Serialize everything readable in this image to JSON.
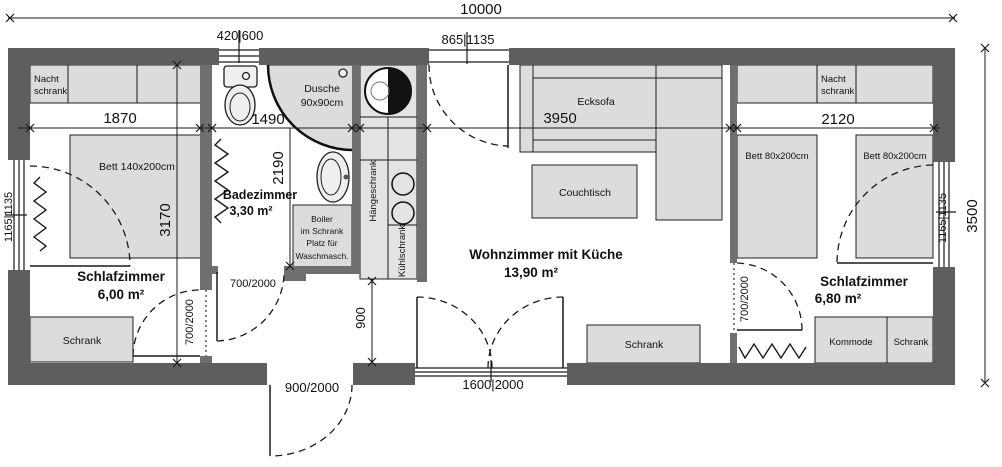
{
  "colors": {
    "wall_exterior": "#5e5e5e",
    "wall_interior": "#6f6f6f",
    "furniture_fill": "#dcdcdc",
    "line": "#1a1a1a",
    "background": "#ffffff"
  },
  "dimensions": {
    "overall_width": "10000",
    "overall_height": "3500",
    "bedroom_left_width": "1870",
    "bathroom_width": "1490",
    "living_width": "3950",
    "bedroom_right_width": "2120",
    "bedroom_left_depth": "3170",
    "bathroom_depth": "2190",
    "kitchen_passage": "900",
    "window_top": "420|600",
    "entry_door": "865|1135",
    "window_left": "1165|1135",
    "window_right": "1165|1135",
    "door_bottom": "900/2000",
    "window_bottom": "1600|2000",
    "door_bedroom_left": "700/2000",
    "door_bathroom": "700/2000",
    "door_bedroom_right": "700/2000"
  },
  "rooms": {
    "bedroom_left": {
      "name": "Schlafzimmer",
      "area": "6,00 m²"
    },
    "bathroom": {
      "name": "Badezimmer",
      "area": "3,30 m²"
    },
    "living": {
      "name": "Wohnzimmer mit Küche",
      "area": "13,90 m²"
    },
    "bedroom_right": {
      "name": "Schlafzimmer",
      "area": "6,80 m²"
    }
  },
  "furniture": {
    "nightstand_left_1": "Nacht",
    "nightstand_left_2": "schrank",
    "bed_left": "Bett 140x200cm",
    "wardrobe_left": "Schrank",
    "shower_1": "Dusche",
    "shower_2": "90x90cm",
    "boiler_1": "Boiler",
    "boiler_2": "im Schrank",
    "boiler_3": "Platz für",
    "boiler_4": "Waschmasch.",
    "wall_cabinet": "Hängeschrank",
    "fridge": "Kühlschrank",
    "sofa": "Ecksofa",
    "coffee_table": "Couchtisch",
    "wardrobe_living": "Schrank",
    "nightstand_right_1": "Nacht",
    "nightstand_right_2": "schrank",
    "bed_right_1": "Bett 80x200cm",
    "bed_right_2": "Bett 80x200cm",
    "dresser": "Kommode",
    "wardrobe_right": "Schrank"
  }
}
